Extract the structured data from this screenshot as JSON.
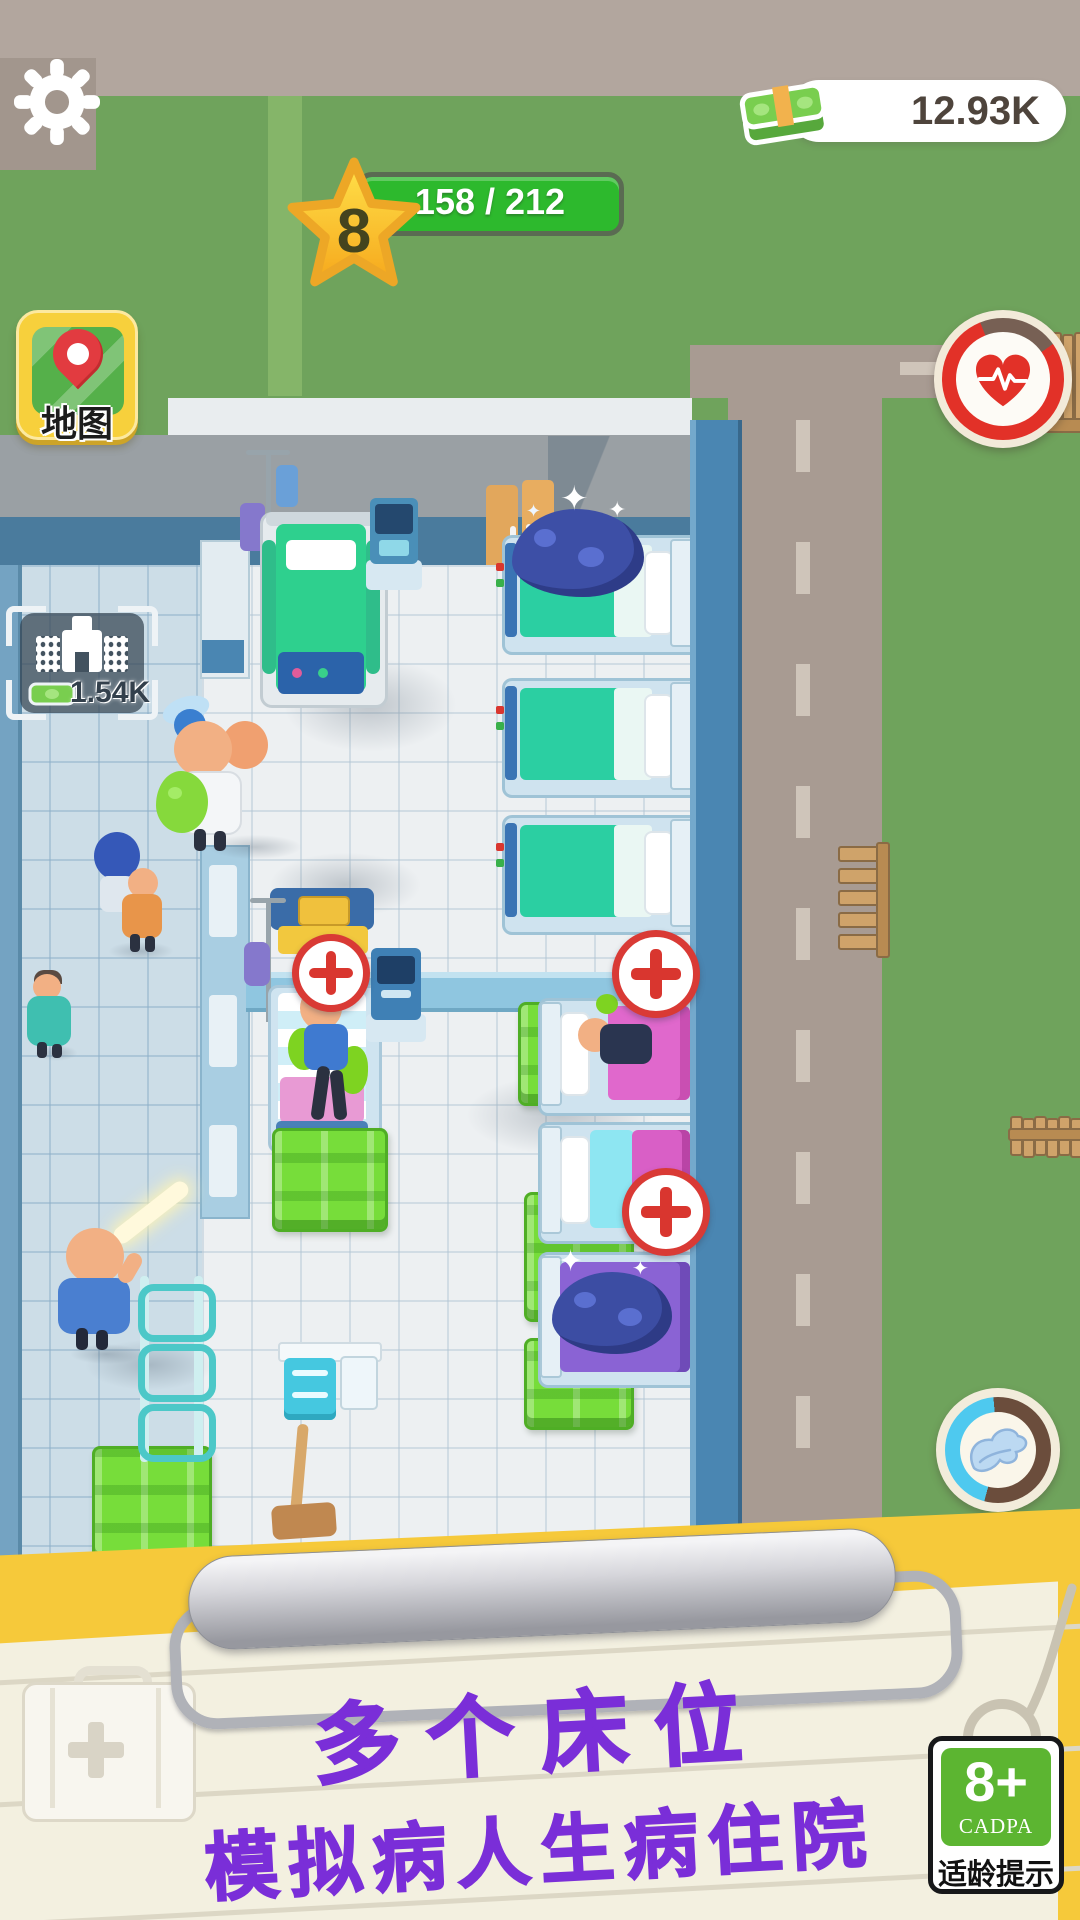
{
  "app": {
    "description": "hospital idle game screenshot"
  },
  "hud": {
    "money": "12.93K",
    "level": "8",
    "level_progress": "158 / 212",
    "map_label": "地图",
    "plot_price": "1.54K"
  },
  "footer": {
    "caption_line1": "多个床位",
    "caption_line2": "模拟病人生病住院",
    "age_badge": {
      "age": "8+",
      "org": "CADPA",
      "label": "适龄提示"
    }
  },
  "icons": {
    "settings": "gear",
    "money": "cash-stack",
    "level": "star",
    "map": "map-location-pin",
    "health": "heart-ecg-ring",
    "speed": "wing-ring",
    "station": "red-cross",
    "sparkle": "✦"
  },
  "colors": {
    "grass": "#6fa35c",
    "road": "#a89b92",
    "wall_blue": "#4a7b9d",
    "progress_green": "#2db92d",
    "money_green": "#77dd3a",
    "accent_yellow": "#f6c93a",
    "caption_purple": "#7a2ed8",
    "age_badge_green": "#5cb531",
    "bed_teal": "#2bcfa2",
    "bed_magenta": "#e068cc"
  }
}
